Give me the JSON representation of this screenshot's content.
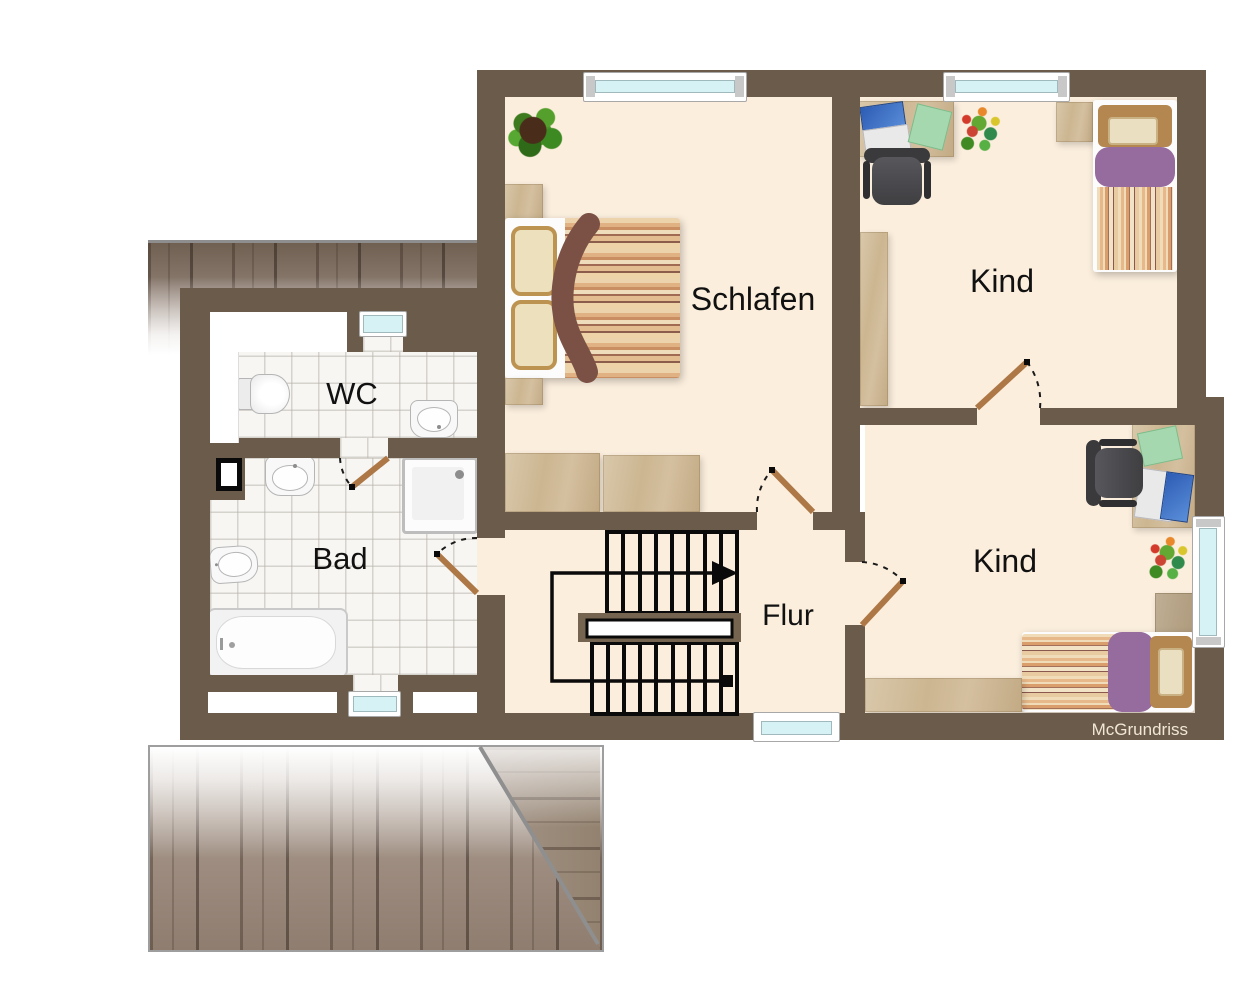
{
  "watermark": "McGrundriss",
  "rooms": {
    "wc": {
      "label": "WC"
    },
    "bad": {
      "label": "Bad"
    },
    "schlafen": {
      "label": "Schlafen"
    },
    "kind_top": {
      "label": "Kind"
    },
    "kind_bottom": {
      "label": "Kind"
    },
    "flur": {
      "label": "Flur"
    }
  },
  "colors": {
    "wall": "#6b5b4a",
    "floor": "#fbeedd",
    "tile_floor": "#f7f6f3",
    "window_glass": "#d6f2f4",
    "wood": "#cfbb9b",
    "duvet_purple": "#966b9d",
    "door_leaf": "#ad7746",
    "roof_wood": "#9a8a7c",
    "stair_lines": "#0a0a0a",
    "label_text": "#111111"
  }
}
